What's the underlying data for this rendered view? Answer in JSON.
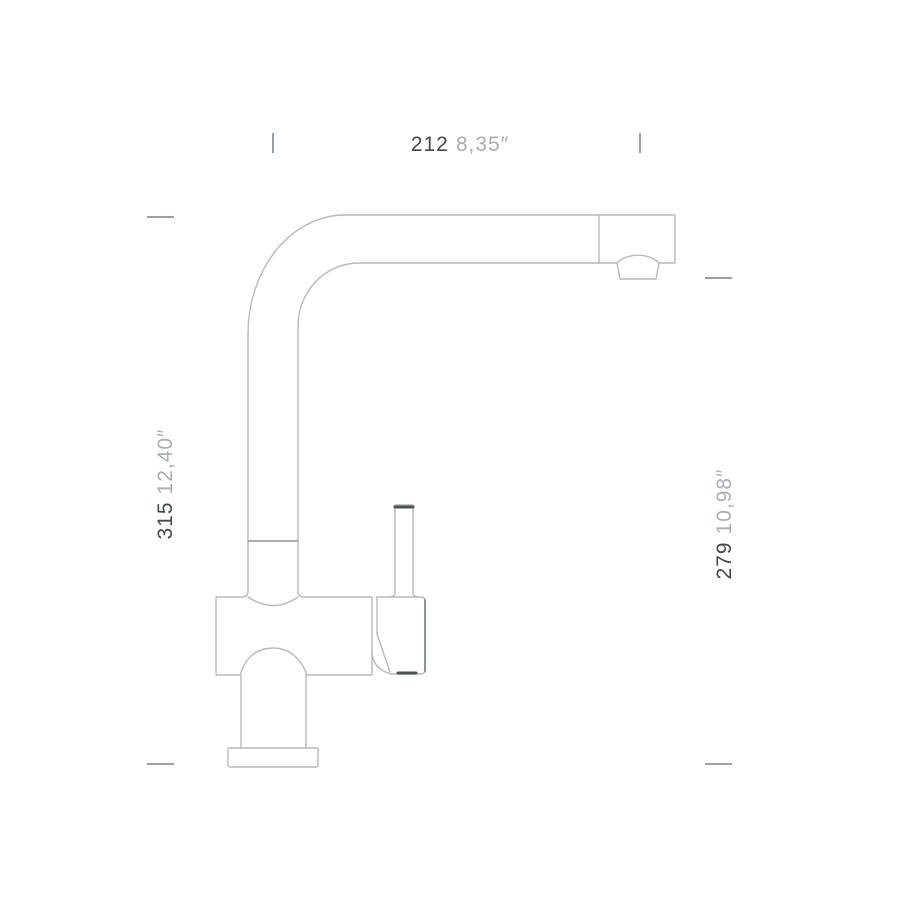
{
  "dimensions": {
    "top": {
      "mm": "212",
      "inches": "8,35″"
    },
    "left": {
      "mm": "315",
      "inches": "12,40″"
    },
    "right": {
      "mm": "279",
      "inches": "10,98″"
    }
  },
  "colors": {
    "line": "#b6babd",
    "line_medium": "#8e9396",
    "line_dark": "#4c5155",
    "tick": "#9aa0a4",
    "dim_mm_text": "#43484c",
    "dim_inches_text": "#a8aeb2",
    "background": "#ffffff"
  }
}
